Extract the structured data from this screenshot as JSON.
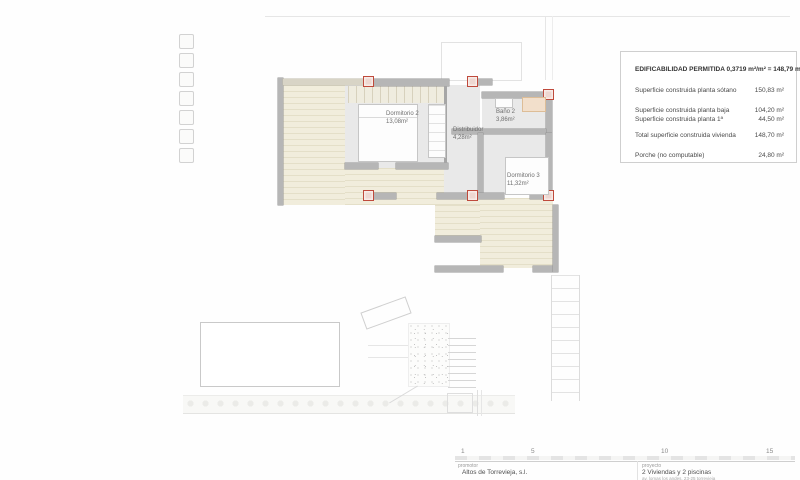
{
  "plan": {
    "rooms": [
      {
        "name": "Dormitorio 2",
        "area": "13,08m²"
      },
      {
        "name": "Baño 2",
        "area": "3,86m²"
      },
      {
        "name": "Distribuidor",
        "area": "4,28m²"
      },
      {
        "name": "Dormitorio 3",
        "area": "11,32m²"
      }
    ]
  },
  "info_box": {
    "title": "EDIFICABILIDAD PERMITIDA 0,3719 m²/m² = 148,79 m²",
    "rows": [
      {
        "label": "Superficie construida planta sótano",
        "value": "150,83 m²"
      },
      {
        "label": "Superficie construida planta baja",
        "value": "104,20 m²"
      },
      {
        "label": "Superficie construida planta 1ª",
        "value": "44,50 m²"
      },
      {
        "label": "Total superficie construida vivienda",
        "value": "148,70 m²"
      },
      {
        "label": "Porche (no computable)",
        "value": "24,80 m²"
      }
    ]
  },
  "scale_bar": {
    "ticks": [
      "1",
      "5",
      "10",
      "15"
    ]
  },
  "title_block": {
    "promoter_label": "promotor",
    "promoter_name": "Altos de Torrevieja, s.l.",
    "project_label": "proyecto",
    "project_name": "2 Viviendas y 2 piscinas",
    "project_address": "av. lomas los andes, 23-25 torrevieja"
  },
  "palette": {
    "column_accent": "#bf4a3c",
    "terrace_fill": "#f1eddc",
    "wall_fill": "#b6b6b6",
    "room_fill": "#e9e9e9"
  }
}
